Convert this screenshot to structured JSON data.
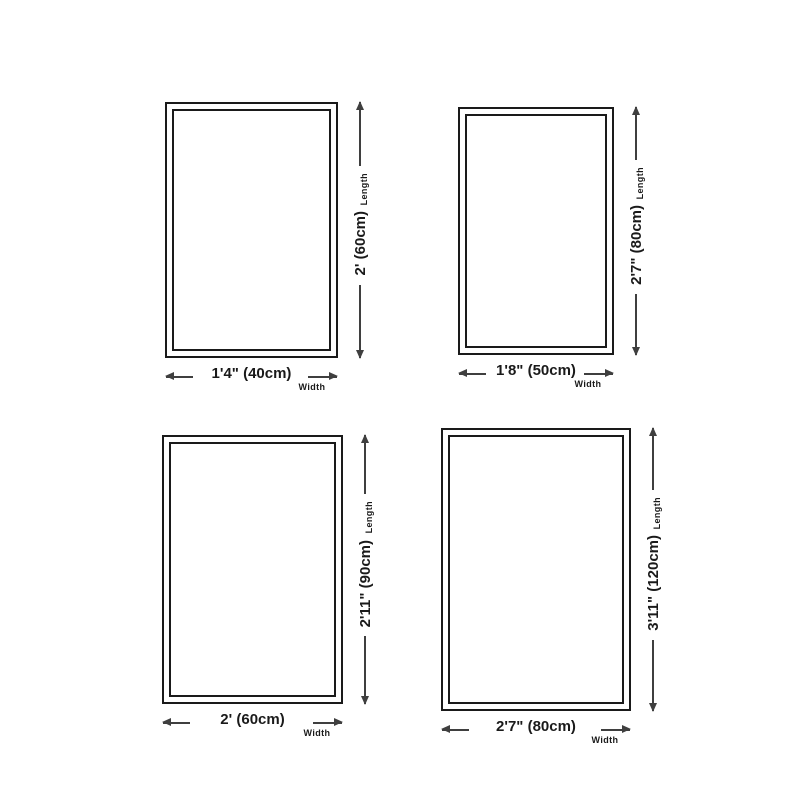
{
  "colors": {
    "background": "#ffffff",
    "frame_border": "#1a1a1a",
    "dimension_line": "#3f3f3f",
    "text": "#1a1a1a"
  },
  "panels": [
    {
      "name": "size-40x60",
      "width_text": "1'4\" (40cm)",
      "length_text": "2' (60cm)",
      "width_label": "Width",
      "length_label": "Length"
    },
    {
      "name": "size-50x80",
      "width_text": "1'8\" (50cm)",
      "length_text": "2'7\" (80cm)",
      "width_label": "Width",
      "length_label": "Length"
    },
    {
      "name": "size-60x90",
      "width_text": "2' (60cm)",
      "length_text": "2'11\" (90cm)",
      "width_label": "Width",
      "length_label": "Length"
    },
    {
      "name": "size-80x120",
      "width_text": "2'7\" (80cm)",
      "length_text": "3'11\" (120cm)",
      "width_label": "Width",
      "length_label": "Length"
    }
  ]
}
